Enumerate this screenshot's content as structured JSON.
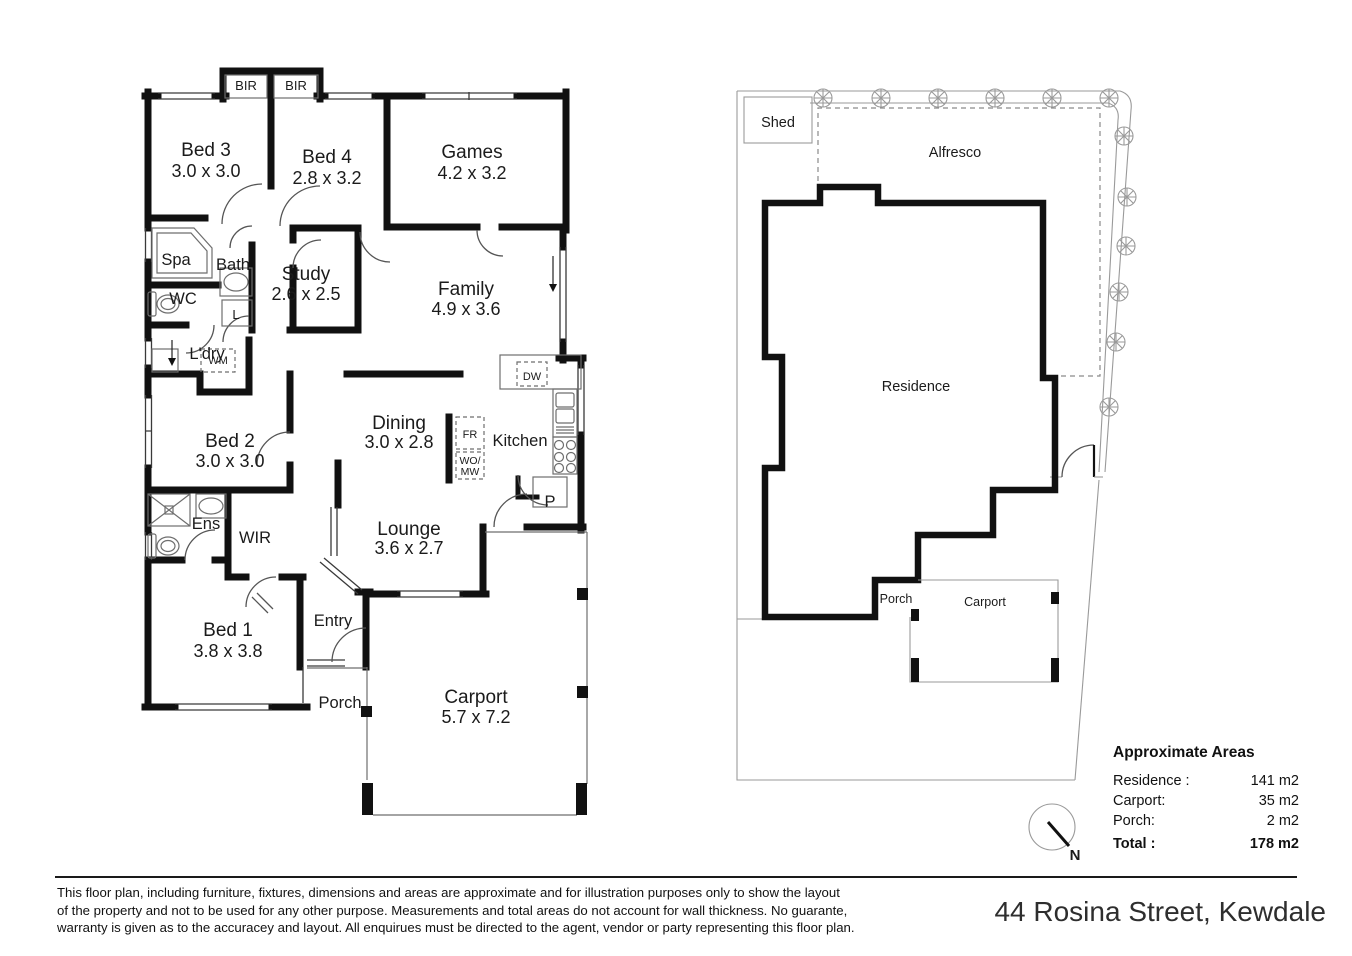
{
  "floor_plan": {
    "bir_left": "BIR",
    "bir_right": "BIR",
    "bed3": "Bed 3",
    "bed3_dim": "3.0 x 3.0",
    "bed4": "Bed 4",
    "bed4_dim": "2.8 x 3.2",
    "games": "Games",
    "games_dim": "4.2 x 3.2",
    "spa": "Spa",
    "bath": "Bath",
    "study": "Study",
    "study_dim": "2.6 x 2.5",
    "family": "Family",
    "family_dim": "4.9 x 3.6",
    "wc": "WC",
    "linen": "L",
    "laundry": "L'dry",
    "wm": "WM",
    "bed2": "Bed 2",
    "bed2_dim": "3.0 x 3.0",
    "dining": "Dining",
    "dining_dim": "3.0 x 2.8",
    "fridge": "FR",
    "kitchen": "Kitchen",
    "dw": "DW",
    "wo": "WO/",
    "mw": "MW",
    "pantry": "P",
    "ens": "Ens",
    "wir": "WIR",
    "lounge": "Lounge",
    "lounge_dim": "3.6 x 2.7",
    "bed1": "Bed 1",
    "bed1_dim": "3.8 x 3.8",
    "entry": "Entry",
    "porch": "Porch",
    "carport": "Carport",
    "carport_dim": "5.7 x 7.2"
  },
  "site_plan": {
    "shed": "Shed",
    "alfresco": "Alfresco",
    "residence": "Residence",
    "porch": "Porch",
    "carport": "Carport"
  },
  "areas": {
    "title": "Approximate Areas",
    "rows": [
      {
        "label": "Residence :",
        "value": "141 m2"
      },
      {
        "label": "Carport:",
        "value": "35 m2"
      },
      {
        "label": "Porch:",
        "value": "2 m2"
      }
    ],
    "total_label": "Total :",
    "total_value": "178 m2"
  },
  "compass": {
    "label": "N"
  },
  "footer": {
    "line1": "This floor plan, including furniture, fixtures, dimensions and areas are approximate and for illustration purposes only to show the layout",
    "line2": "of the property and not to be used for any other purpose. Measurements and total areas do not account for wall thickness. No guarante,",
    "line3": "warranty is given as to the accuracey and layout. All enquirues must be directed to the agent, vendor or party representing this floor plan.",
    "address": "44 Rosina Street, Kewdale"
  },
  "colors": {
    "wall": "#111111",
    "fixture_line": "#6e6e6e",
    "boundary": "#9a9a9a",
    "dashed": "#8a8a8a"
  }
}
